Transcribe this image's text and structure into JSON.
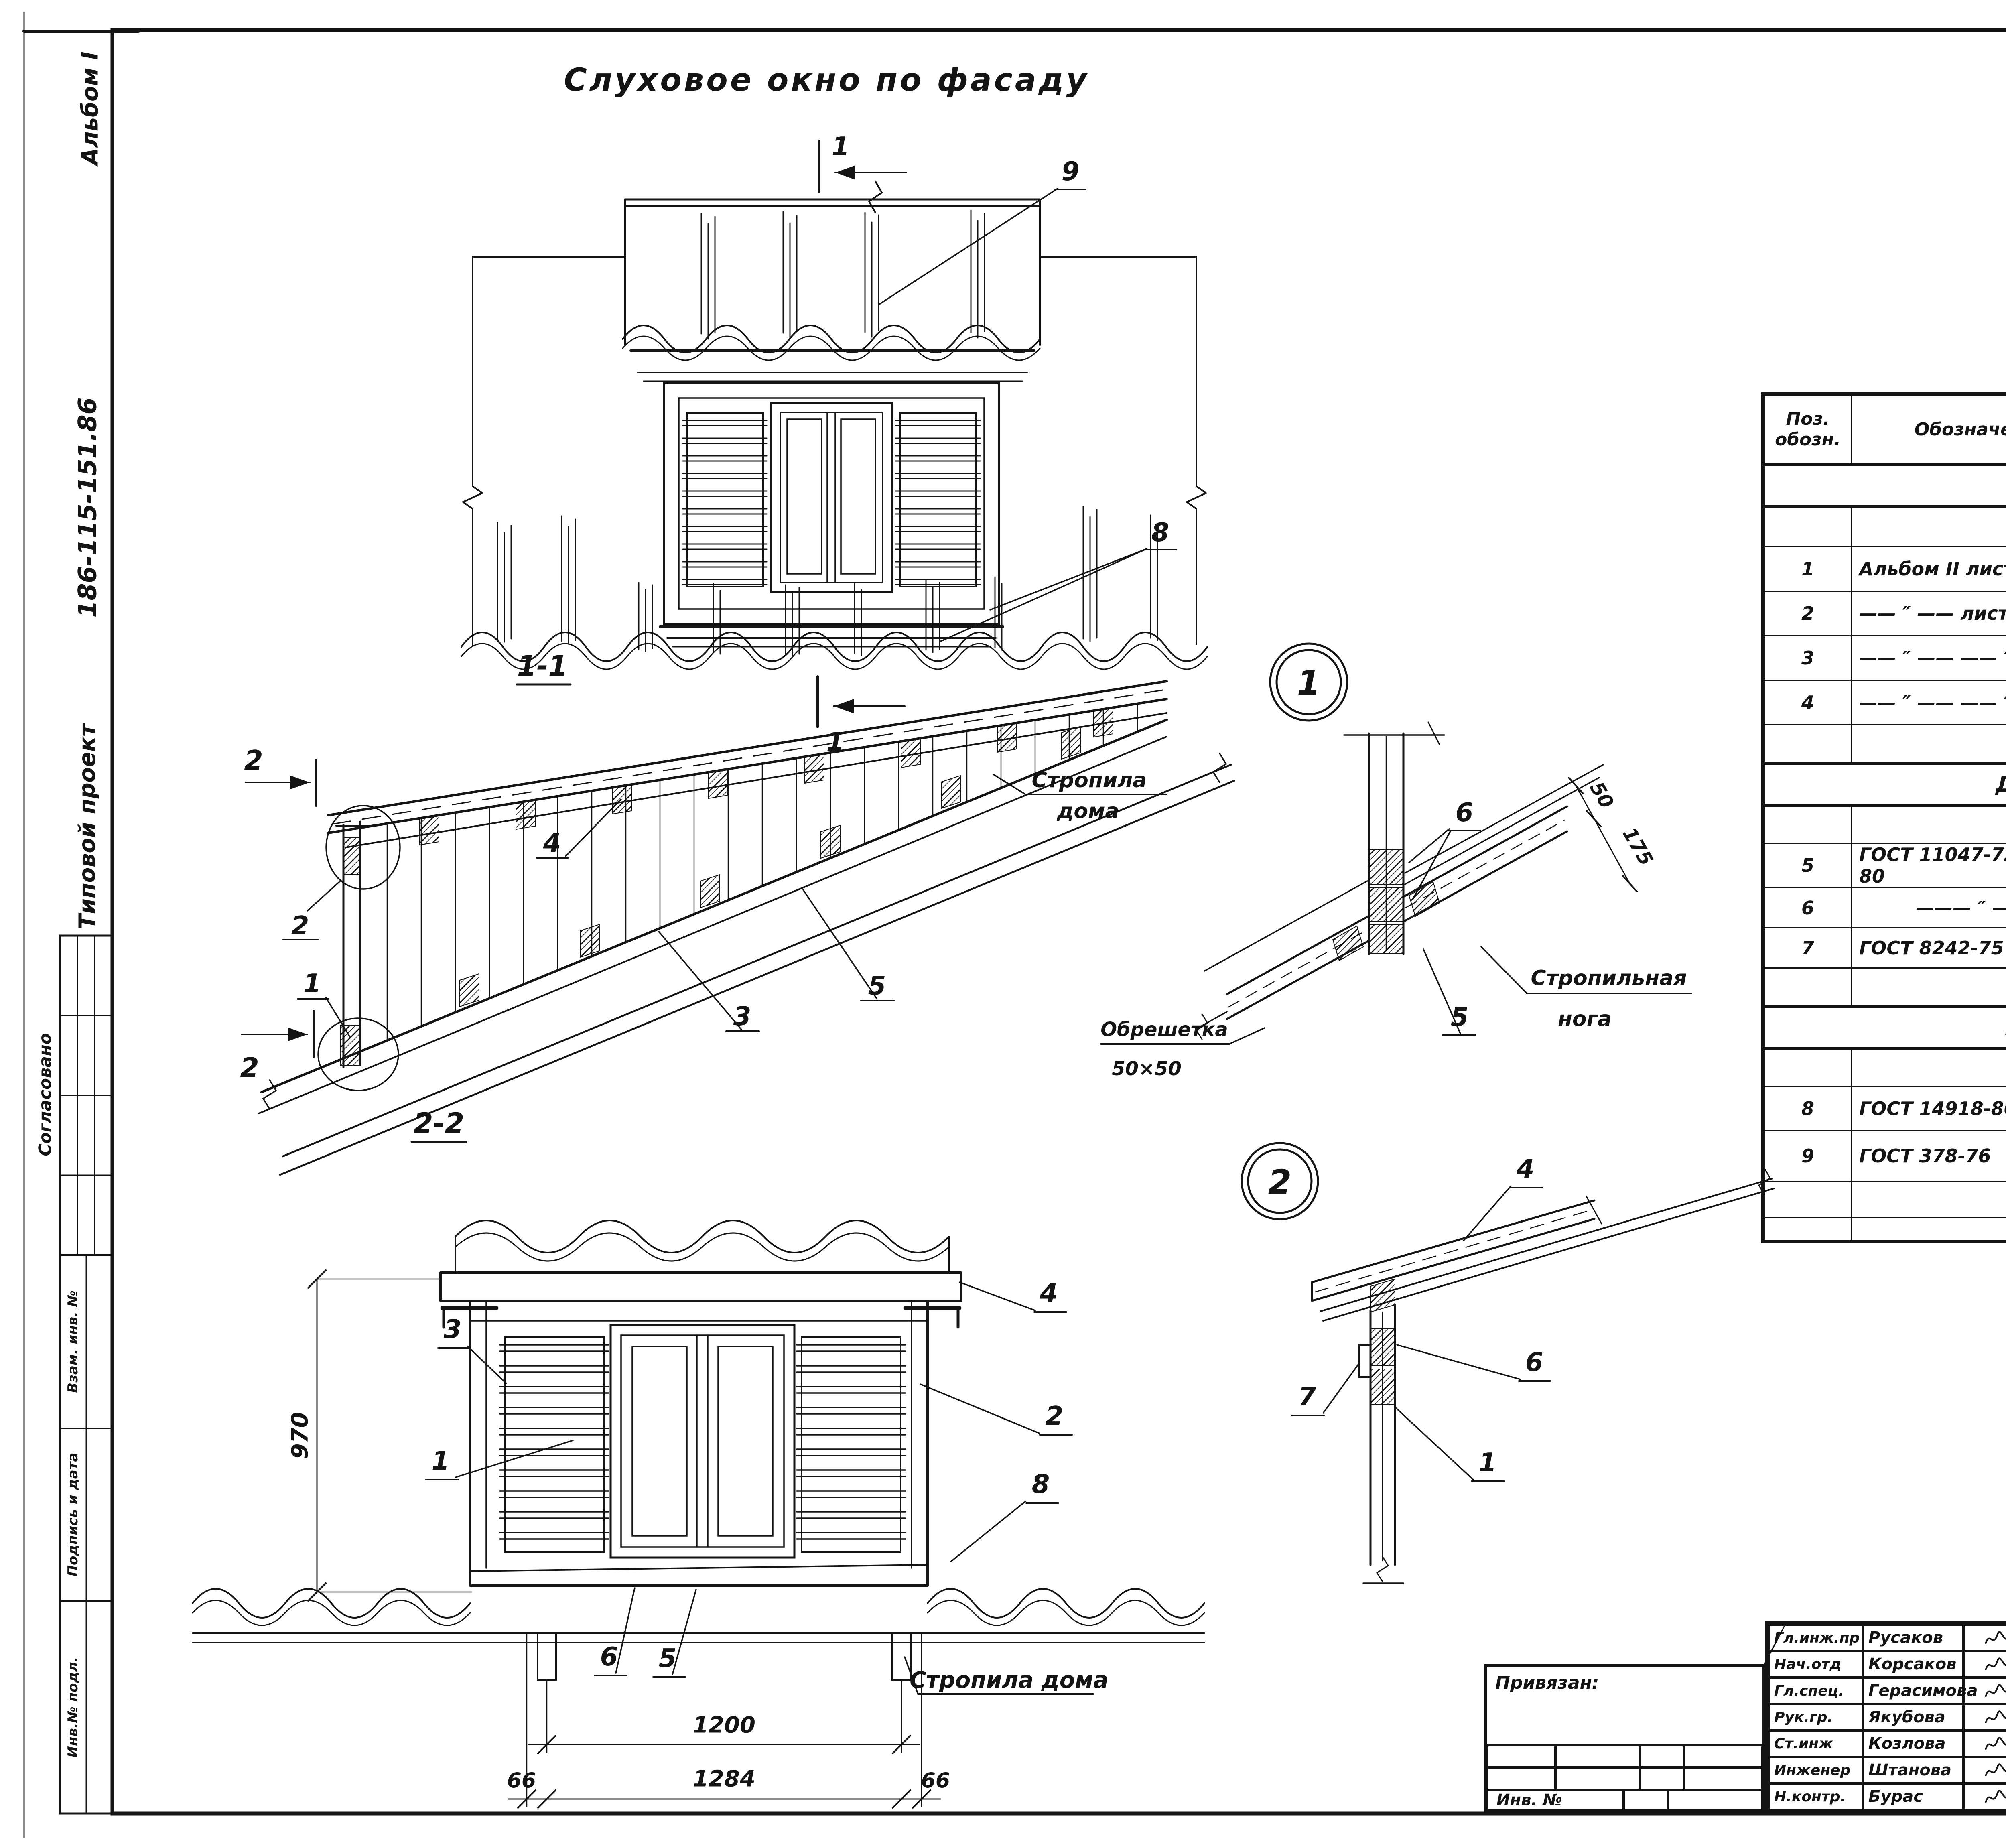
{
  "margin": {
    "album": "Альбом I",
    "doc": "186-115-151.86",
    "type": "Типовой проект",
    "agreed": "Согласовано",
    "vzam": "Взам. инв. №",
    "sign": "Подпись и дата",
    "inv": "Инв.№ подл."
  },
  "drawing": {
    "facade": {
      "title": "Слуховое окно по фасаду",
      "c9": "9",
      "sec1_top": "1",
      "sec1_bot": "1",
      "c8": "8"
    },
    "s11": {
      "title": "1-1",
      "sec2_top": "2",
      "sec2_bot": "2",
      "c2": "2",
      "c1": "1",
      "c4": "4",
      "c3": "3",
      "c5": "5",
      "note1": "Стропила",
      "note2": "дома"
    },
    "s22": {
      "title": "2-2",
      "c3": "3",
      "c1": "1",
      "c4": "4",
      "c2": "2",
      "c8": "8",
      "c6": "6",
      "c5": "5",
      "d970": "970",
      "d1200": "1200",
      "d1284": "1284",
      "d66l": "66",
      "d66r": "66",
      "note": "Стропила дома"
    },
    "det1": {
      "num": "1",
      "c6": "6",
      "c5": "5",
      "d50": "50",
      "d175": "175",
      "note1": "Стропильная",
      "note2": "нога",
      "lath1": "Обрешетка",
      "lath2": "50×50"
    },
    "det2": {
      "num": "2",
      "c4": "4",
      "c6": "6",
      "c7": "7",
      "c1": "1"
    }
  },
  "spec": {
    "title": "Спецификация",
    "headers": {
      "pos": "Поз.\nобозн.",
      "des": "Обозначение",
      "name": "Наименование",
      "qty": "Кол.\nшт.",
      "mass": "Масса\nед. кг",
      "note": "Приме-\nчание"
    },
    "sections": {
      "izdeliya": "Изделия",
      "detali": "Детали  деревянные",
      "prochie": "Прочие  материалы"
    },
    "rows": [
      {
        "pos": "1",
        "des": "Альбом II    лист 4",
        "name": "Ф8-1 Оконный блок     комп.",
        "qty": "1",
        "mass": "",
        "note": ""
      },
      {
        "pos": "2",
        "des": "—— ″ ——  лист 5",
        "name": "Ф8-2 Боковой щит правый",
        "qty": "1",
        "mass": "",
        "note": ""
      },
      {
        "pos": "3",
        "des": "—— ″ ——    —— ″ ——",
        "name": "Ф8-2л Боковой щит левый",
        "qty": "1",
        "mass": "",
        "note": ""
      },
      {
        "pos": "4",
        "des": "—— ″ ——    —— ″ ——",
        "name": "Ф8-3 Кровельный щит",
        "qty": "1",
        "mass": "",
        "note": ""
      },
      {
        "pos": "5",
        "des": "ГОСТ 11047-72, 24454-80",
        "name": "Ригель 50×75 × 1400",
        "qty": "2",
        "mass": "",
        "note": ""
      },
      {
        "pos": "6",
        "des": "——— ″ ———",
        "name": "Ригель слухового окна 50×75×1284",
        "qty": "2",
        "mass": "",
        "note": ""
      },
      {
        "pos": "7",
        "des": "ГОСТ 8242-75",
        "name": "Наличник    13×54        п.м.",
        "qty": "4,0",
        "mass": "",
        "note": ""
      },
      {
        "pos": "8",
        "des": "ГОСТ 14918-80",
        "name": "Сталь кровельная оцинко-\nванная  δ=0,65                м²",
        "qty": "5,5",
        "mass": "",
        "note": ""
      },
      {
        "pos": "9",
        "des": "ГОСТ 378-76",
        "name": "Листы асбестоцементные\nволнистые ВО 5,5×686×1200",
        "qty": "—",
        "mass": "",
        "note": "Учтены на\nлисте АС-18"
      }
    ]
  },
  "tb": {
    "staff": [
      {
        "role": "Гл.инж.пр",
        "name": "Русаков"
      },
      {
        "role": "Нач.отд",
        "name": "Корсаков"
      },
      {
        "role": "Гл.спец.",
        "name": "Герасимова"
      },
      {
        "role": "Рук.гр.",
        "name": "Якубова"
      },
      {
        "role": "Ст.инж",
        "name": "Козлова"
      },
      {
        "role": "Инженер",
        "name": "Штанова"
      },
      {
        "role": "Н.контр.",
        "name": "Бурас"
      }
    ],
    "doc": "186 - 115 - 151, 86 Ал. I",
    "kind": "КД",
    "proj1": "Одноэтажный 2-квартирный",
    "proj2": "с 2-комнатными квартирами",
    "proj3": "жилой дом",
    "stage_l": "Стадия",
    "sheet_l": "Лист",
    "sheets_l": "Листов",
    "stage": "РД",
    "sheet": "20",
    "sheets": "",
    "title": "Слуховое окно Ф8",
    "org": "ГИПРОЛЕСПРОМ",
    "stamp": "21833-01   33",
    "attached": "Привязан:",
    "inv": "Инв. №"
  }
}
